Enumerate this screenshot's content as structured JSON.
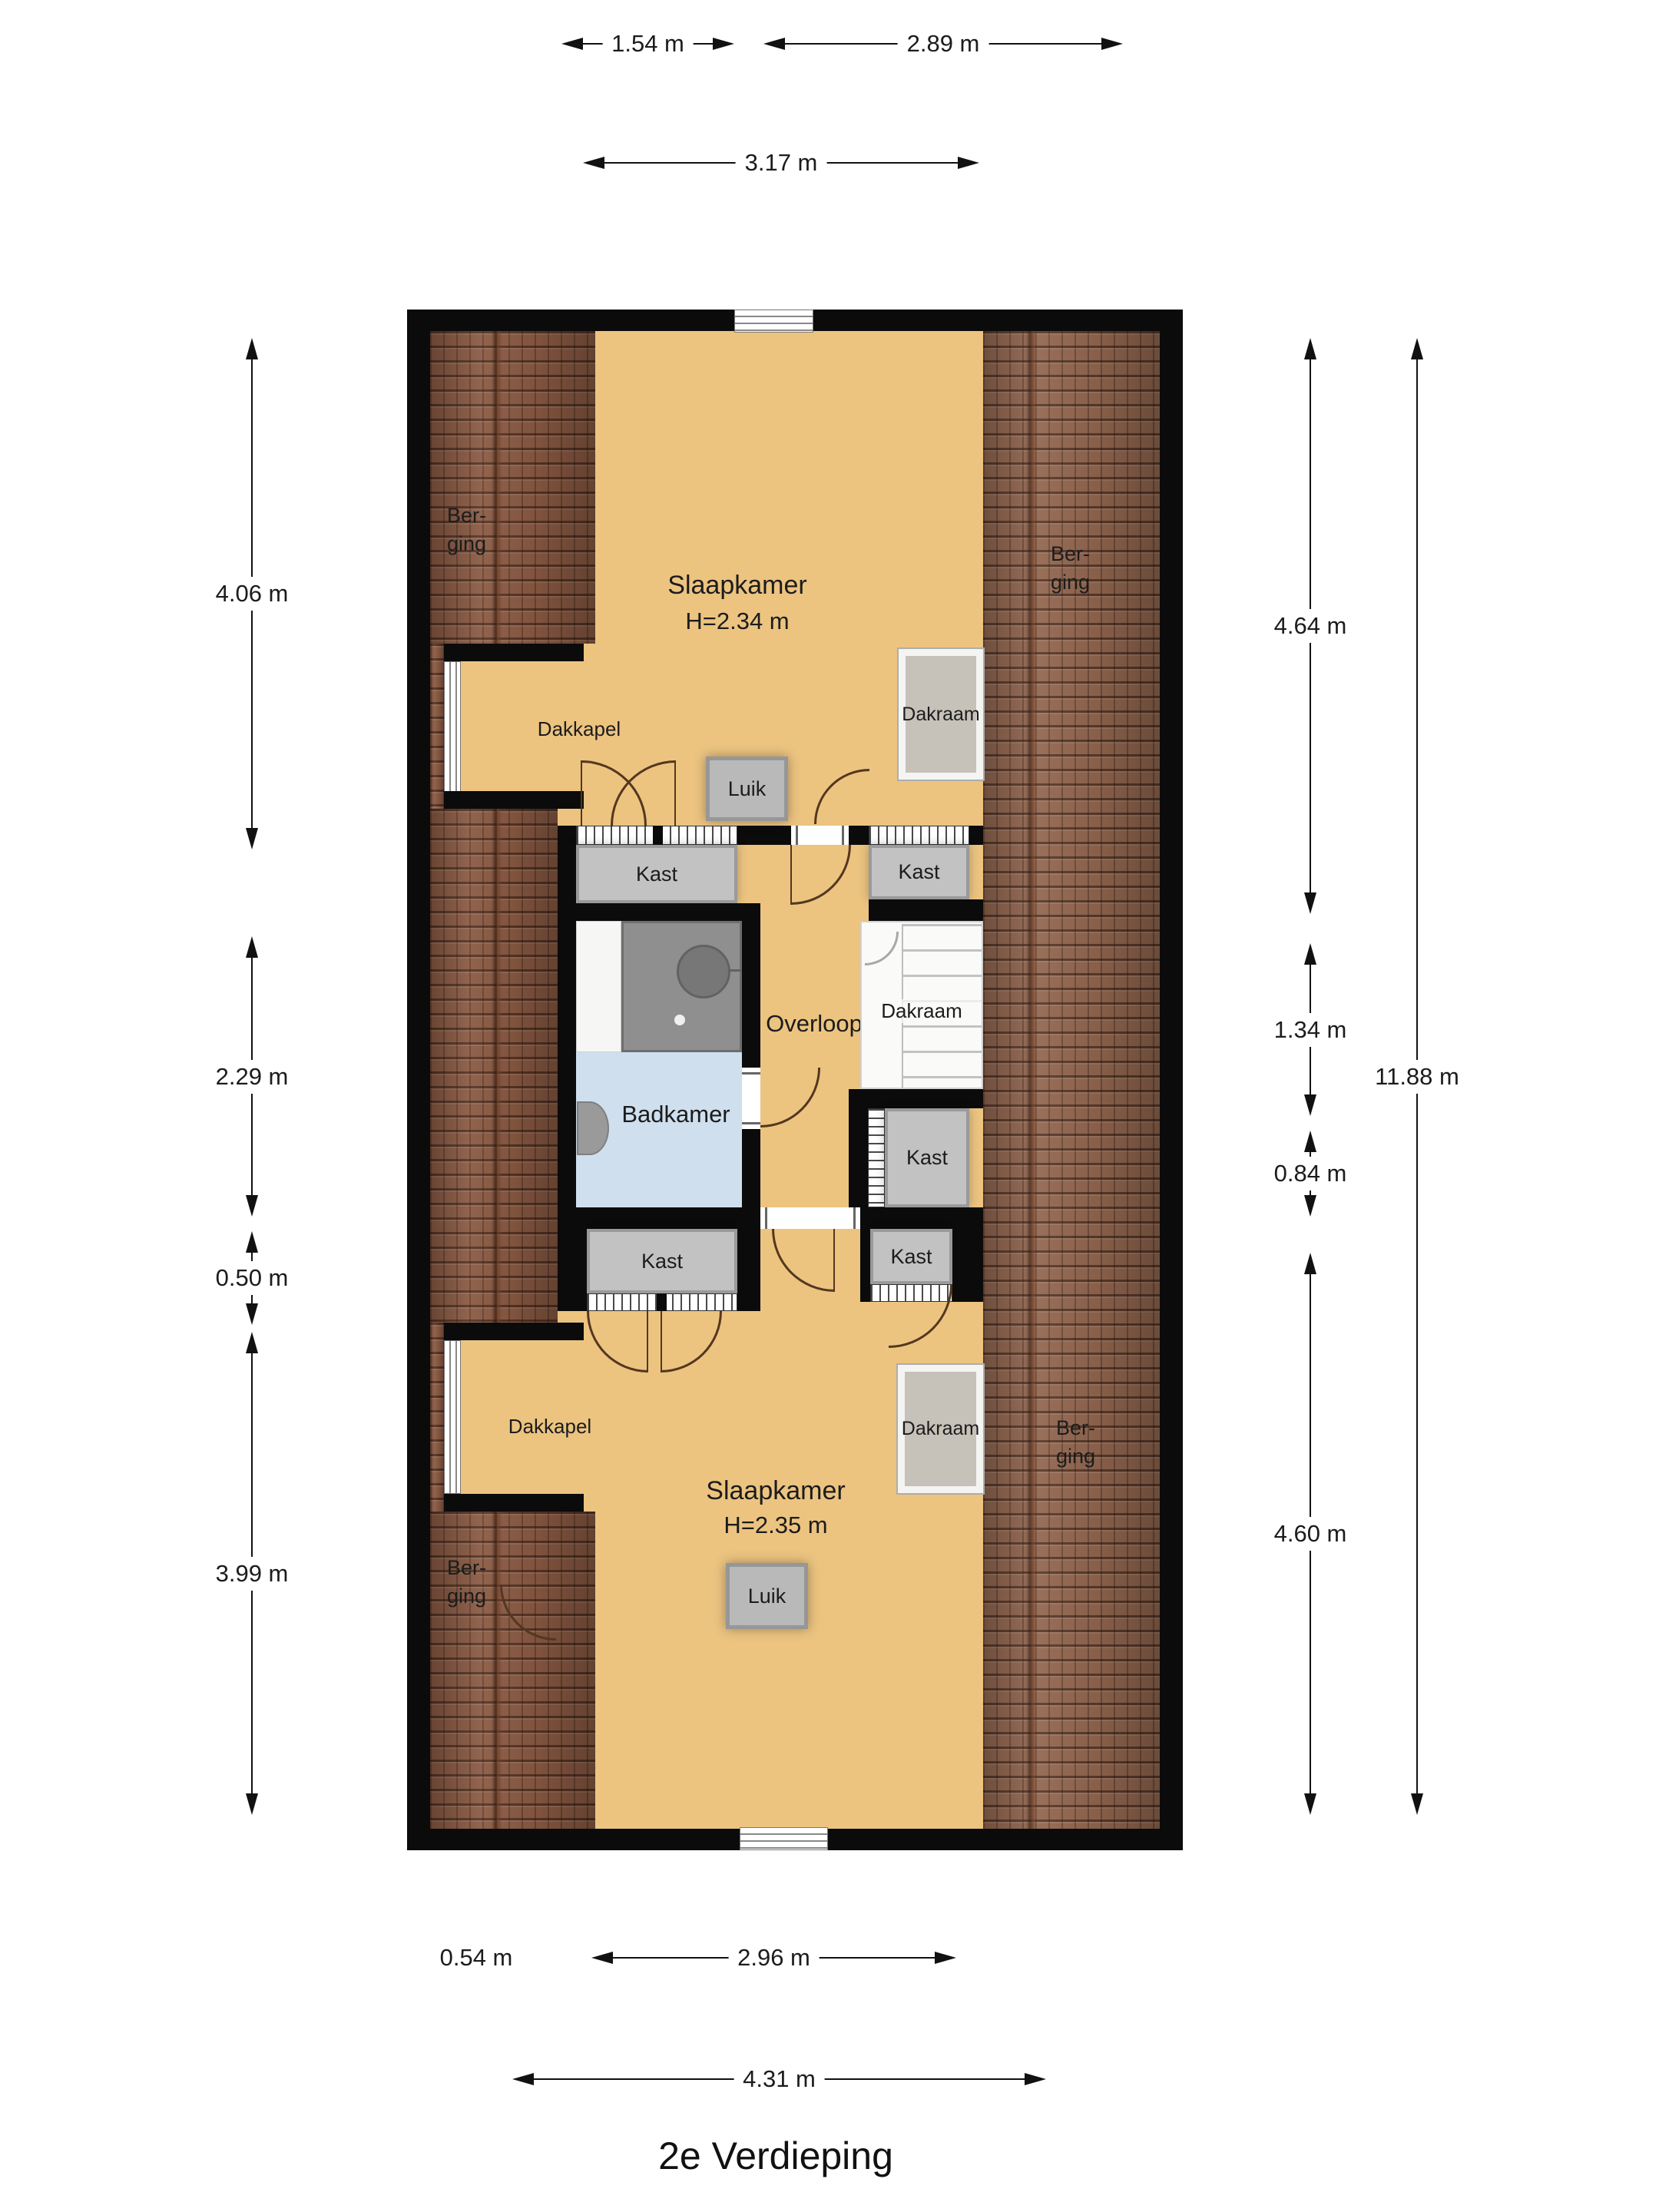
{
  "title": "2e Verdieping",
  "labels": {
    "kast": "Kast",
    "luik": "Luik",
    "dakraam": "Dakraam",
    "dakkapel": "Dakkapel",
    "berging_l1": "Ber-",
    "berging_l2": "ging",
    "badkamer": "Badkamer",
    "overloop": "Overloop"
  },
  "rooms": {
    "slaapkamer_top": {
      "name": "Slaapkamer",
      "ceiling": "H=2.34 m"
    },
    "slaapkamer_bottom": {
      "name": "Slaapkamer",
      "ceiling": "H=2.35 m"
    }
  },
  "dimensions": {
    "top": [
      {
        "label": "1.54 m"
      },
      {
        "label": "2.89 m"
      },
      {
        "label": "3.17 m"
      }
    ],
    "left": [
      {
        "label": "4.06 m"
      },
      {
        "label": "2.29 m"
      },
      {
        "label": "0.50 m"
      },
      {
        "label": "3.99 m"
      }
    ],
    "right": [
      {
        "label": "4.64 m"
      },
      {
        "label": "1.34 m"
      },
      {
        "label": "0.84 m"
      },
      {
        "label": "4.60 m"
      },
      {
        "label": "11.88 m"
      }
    ],
    "bottom": [
      {
        "label": "0.54 m"
      },
      {
        "label": "2.96 m"
      },
      {
        "label": "4.31 m"
      }
    ]
  },
  "colors": {
    "floor": "#ecc480",
    "roof": "#8a5a43",
    "bathroom": "#cfdfee",
    "wall": "#0b0b0b"
  }
}
